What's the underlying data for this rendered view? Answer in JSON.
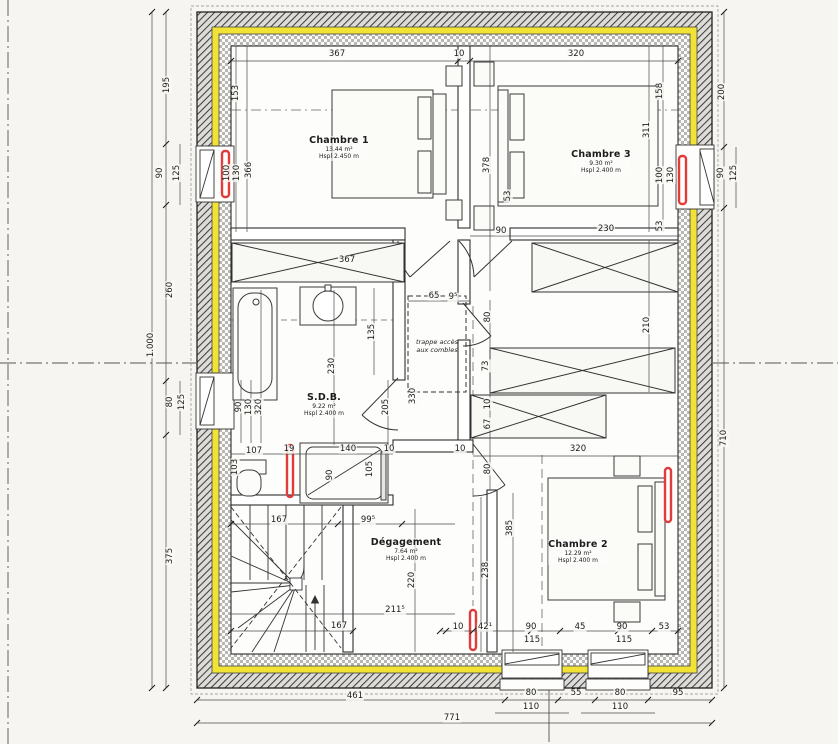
{
  "drawing": {
    "kind": "floor-plan",
    "colors": {
      "insulation_yellow": "#f1e335",
      "radiator_red": "#e03c3c",
      "paper": "#f6f5f1",
      "line": "#2b2b2b"
    }
  },
  "rooms": [
    {
      "name": "Chambre 1",
      "area": "13.44 m²",
      "ceiling": "Hspl 2.450 m",
      "x": 339,
      "y": 136
    },
    {
      "name": "Chambre 3",
      "area": "9.30 m²",
      "ceiling": "Hspl 2.400 m",
      "x": 601,
      "y": 150
    },
    {
      "name": "S.D.B.",
      "area": "9.22 m²",
      "ceiling": "Hspl 2.400 m",
      "x": 324,
      "y": 393
    },
    {
      "name": "Dégagement",
      "area": "7.64 m²",
      "ceiling": "Hspl 2.400 m",
      "x": 406,
      "y": 538
    },
    {
      "name": "Chambre 2",
      "area": "12.29 m²",
      "ceiling": "Hspl 2.400 m",
      "x": 578,
      "y": 540
    }
  ],
  "annotations": {
    "trappe": "trappe accès aux combles"
  },
  "dimensions": [
    {
      "t": "367",
      "x": 337,
      "y": 54
    },
    {
      "t": "10",
      "x": 459,
      "y": 54
    },
    {
      "t": "320",
      "x": 576,
      "y": 54
    },
    {
      "t": "195",
      "x": 167,
      "y": 85,
      "r": 1
    },
    {
      "t": "90",
      "x": 160,
      "y": 173,
      "r": 1
    },
    {
      "t": "125",
      "x": 177,
      "y": 173,
      "r": 1
    },
    {
      "t": "260",
      "x": 170,
      "y": 290,
      "r": 1
    },
    {
      "t": "1.000",
      "x": 151,
      "y": 345,
      "r": 1
    },
    {
      "t": "80",
      "x": 170,
      "y": 402,
      "r": 1
    },
    {
      "t": "125",
      "x": 182,
      "y": 402,
      "r": 1
    },
    {
      "t": "375",
      "x": 170,
      "y": 556,
      "r": 1
    },
    {
      "t": "200",
      "x": 722,
      "y": 92,
      "r": 1
    },
    {
      "t": "90",
      "x": 721,
      "y": 173,
      "r": 1
    },
    {
      "t": "125",
      "x": 734,
      "y": 173,
      "r": 1
    },
    {
      "t": "710",
      "x": 724,
      "y": 438,
      "r": 1
    },
    {
      "t": "461",
      "x": 355,
      "y": 696
    },
    {
      "t": "80",
      "x": 531,
      "y": 693
    },
    {
      "t": "110",
      "x": 531,
      "y": 707
    },
    {
      "t": "55",
      "x": 576,
      "y": 693
    },
    {
      "t": "80",
      "x": 620,
      "y": 693
    },
    {
      "t": "110",
      "x": 620,
      "y": 707
    },
    {
      "t": "95",
      "x": 678,
      "y": 693
    },
    {
      "t": "771",
      "x": 452,
      "y": 718
    },
    {
      "t": "153",
      "x": 236,
      "y": 93,
      "r": 1
    },
    {
      "t": "100",
      "x": 227,
      "y": 173,
      "r": 1
    },
    {
      "t": "130",
      "x": 237,
      "y": 173,
      "r": 1
    },
    {
      "t": "366",
      "x": 249,
      "y": 170,
      "r": 1
    },
    {
      "t": "158",
      "x": 660,
      "y": 91,
      "r": 1
    },
    {
      "t": "311",
      "x": 647,
      "y": 130,
      "r": 1
    },
    {
      "t": "100",
      "x": 660,
      "y": 175,
      "r": 1
    },
    {
      "t": "130",
      "x": 671,
      "y": 175,
      "r": 1
    },
    {
      "t": "53",
      "x": 660,
      "y": 226,
      "r": 1
    },
    {
      "t": "210",
      "x": 647,
      "y": 325,
      "r": 1
    },
    {
      "t": "378",
      "x": 487,
      "y": 165,
      "r": 1
    },
    {
      "t": "53",
      "x": 508,
      "y": 196,
      "r": 1
    },
    {
      "t": "90",
      "x": 501,
      "y": 231
    },
    {
      "t": "230",
      "x": 606,
      "y": 229
    },
    {
      "t": "367",
      "x": 347,
      "y": 260
    },
    {
      "t": "135",
      "x": 372,
      "y": 332,
      "r": 1
    },
    {
      "t": "230",
      "x": 332,
      "y": 366,
      "r": 1
    },
    {
      "t": "330",
      "x": 413,
      "y": 396,
      "r": 1
    },
    {
      "t": "205",
      "x": 386,
      "y": 407,
      "r": 1
    },
    {
      "t": "90",
      "x": 239,
      "y": 407,
      "r": 1
    },
    {
      "t": "130",
      "x": 249,
      "y": 407,
      "r": 1
    },
    {
      "t": "320",
      "x": 259,
      "y": 407,
      "r": 1
    },
    {
      "t": "107",
      "x": 254,
      "y": 451
    },
    {
      "t": "19",
      "x": 289,
      "y": 449
    },
    {
      "t": "140",
      "x": 348,
      "y": 449
    },
    {
      "t": "10",
      "x": 389,
      "y": 449
    },
    {
      "t": "103",
      "x": 235,
      "y": 467,
      "r": 1
    },
    {
      "t": "90",
      "x": 330,
      "y": 475,
      "r": 1
    },
    {
      "t": "105",
      "x": 370,
      "y": 469,
      "r": 1
    },
    {
      "t": "167",
      "x": 279,
      "y": 520
    },
    {
      "t": "99⁵",
      "x": 368,
      "y": 520
    },
    {
      "t": "220",
      "x": 412,
      "y": 580,
      "r": 1
    },
    {
      "t": "211⁵",
      "x": 395,
      "y": 610
    },
    {
      "t": "167",
      "x": 339,
      "y": 626
    },
    {
      "t": "65",
      "x": 434,
      "y": 296
    },
    {
      "t": "9⁵",
      "x": 453,
      "y": 297
    },
    {
      "t": "80",
      "x": 488,
      "y": 317,
      "r": 1
    },
    {
      "t": "73",
      "x": 486,
      "y": 366,
      "r": 1
    },
    {
      "t": "10",
      "x": 488,
      "y": 404,
      "r": 1
    },
    {
      "t": "67",
      "x": 488,
      "y": 424,
      "r": 1
    },
    {
      "t": "10",
      "x": 460,
      "y": 449
    },
    {
      "t": "80",
      "x": 488,
      "y": 469,
      "r": 1
    },
    {
      "t": "385",
      "x": 510,
      "y": 528,
      "r": 1
    },
    {
      "t": "238",
      "x": 486,
      "y": 570,
      "r": 1
    },
    {
      "t": "320",
      "x": 578,
      "y": 449
    },
    {
      "t": "10",
      "x": 458,
      "y": 627
    },
    {
      "t": "42¹",
      "x": 485,
      "y": 627
    },
    {
      "t": "90",
      "x": 531,
      "y": 627
    },
    {
      "t": "115",
      "x": 532,
      "y": 640
    },
    {
      "t": "45",
      "x": 580,
      "y": 627
    },
    {
      "t": "90",
      "x": 622,
      "y": 627
    },
    {
      "t": "115",
      "x": 624,
      "y": 640
    },
    {
      "t": "53",
      "x": 664,
      "y": 627
    }
  ]
}
